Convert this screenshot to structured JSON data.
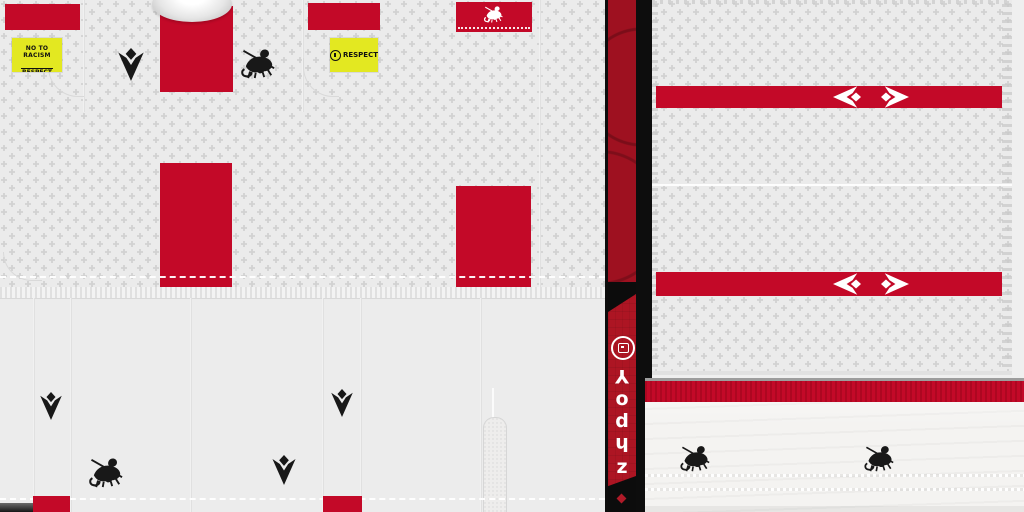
{
  "sheet": {
    "description": "Football kit texture sheet (white/red kit with Macron logos and Georgian crest)"
  },
  "colors": {
    "kit_red": "#c30928",
    "banner_red_dark": "#9e1120",
    "banner_red_bright": "#ad1523",
    "badge_yellow": "#e3e821",
    "fabric_light": "#ebebeb",
    "shorts_grey": "#ececec",
    "sock_offwhite": "#f4f3f1",
    "black": "#0d0d0d",
    "white": "#ffffff"
  },
  "badges": {
    "no_to_racism": {
      "line1": "NO TO RACISM",
      "line2": "RESPECT"
    },
    "respect": {
      "label": "RESPECT"
    }
  },
  "banner": {
    "letters": [
      "Y",
      "o",
      "d",
      "h",
      "z"
    ]
  }
}
